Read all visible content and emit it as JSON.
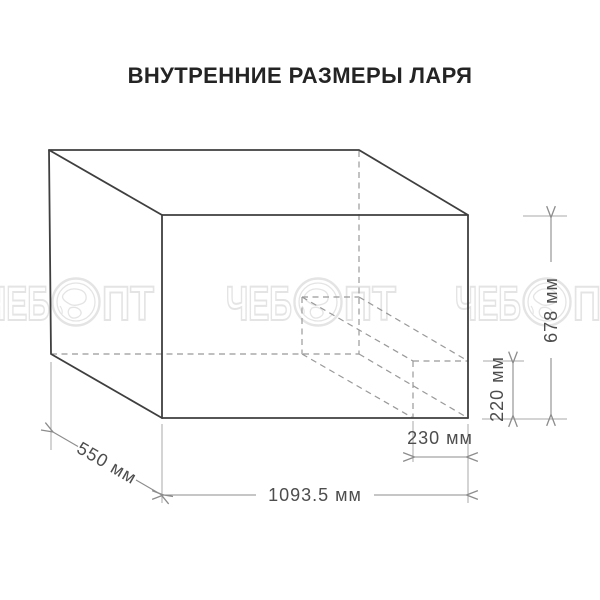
{
  "title": "ВНУТРЕННИЕ РАЗМЕРЫ ЛАРЯ",
  "watermark": {
    "prefix": "ЧЕБ",
    "suffix": "ПТ",
    "logo": "globe-icon",
    "color": "#e4e4e4"
  },
  "diagram": {
    "type": "isometric-wireframe-box",
    "subject": "internal dimensions of chest freezer",
    "dimensions": {
      "width": {
        "value": 1093.5,
        "unit": "мм",
        "label": "1093.5 мм"
      },
      "depth": {
        "value": 550,
        "unit": "мм",
        "label": "550 мм"
      },
      "height": {
        "value": 678,
        "unit": "мм",
        "label": "678 мм"
      },
      "step_height": {
        "value": 220,
        "unit": "мм",
        "label": "220 мм"
      },
      "step_width": {
        "value": 230,
        "unit": "мм",
        "label": "230 мм"
      }
    },
    "colors": {
      "outline": "#3f3f3f",
      "hidden_edge": "#999999",
      "dimension_line": "#8c8c8c",
      "label_text": "#4d4d4d"
    }
  }
}
